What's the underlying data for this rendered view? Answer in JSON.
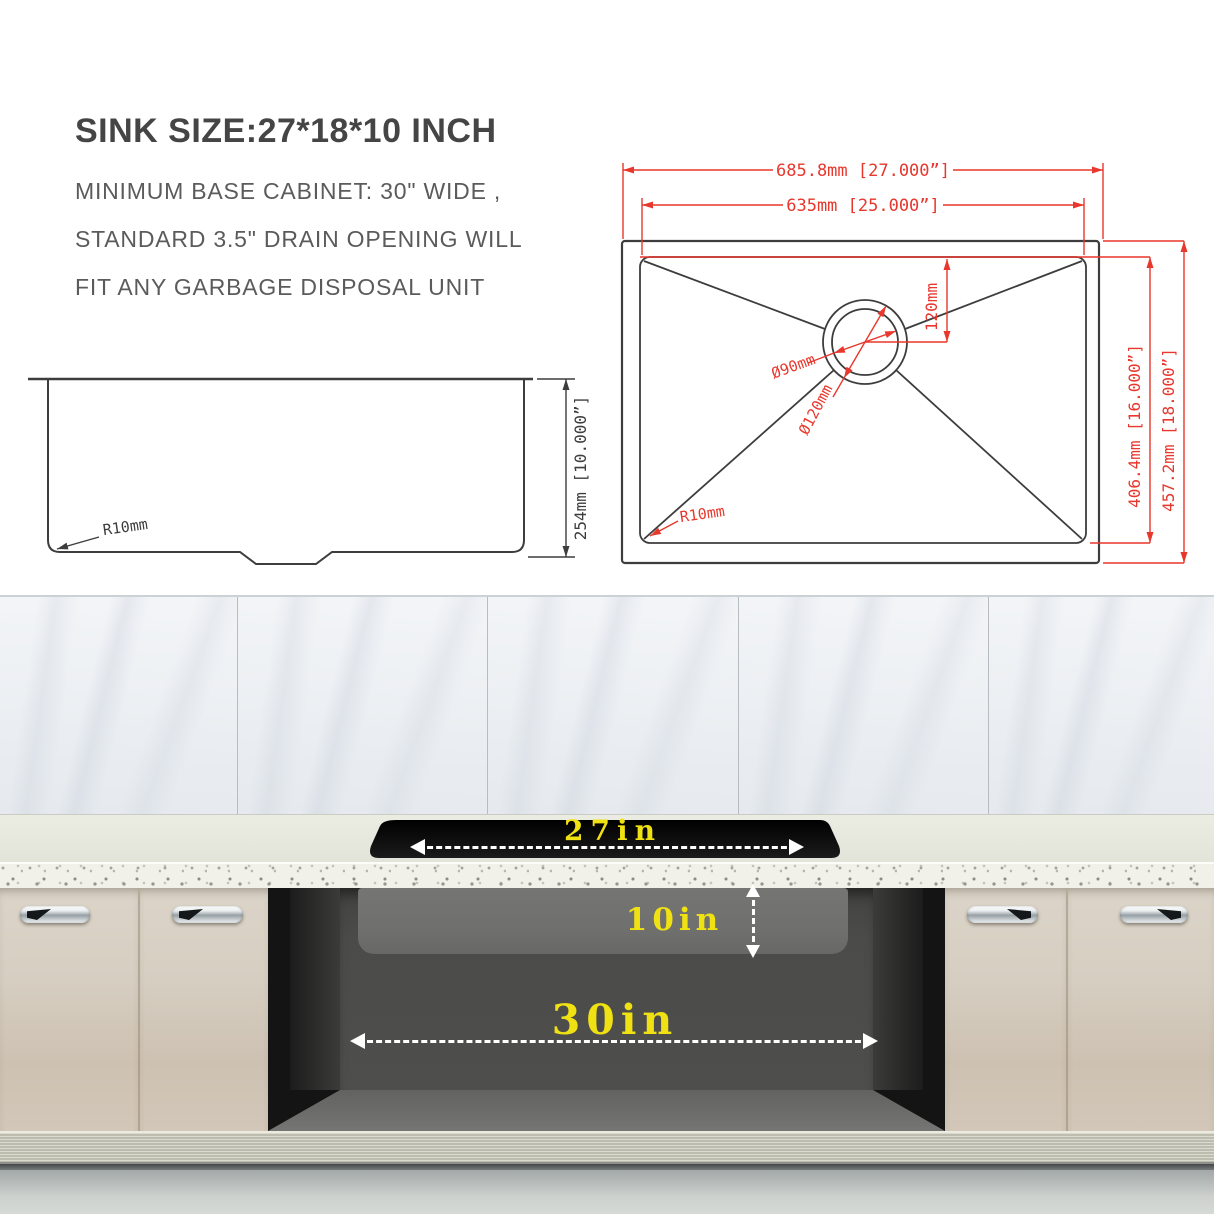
{
  "title_block": {
    "title": "SINK SIZE:27*18*10 INCH",
    "lines": [
      "MINIMUM BASE CABINET: 30\" WIDE ,",
      "STANDARD 3.5\" DRAIN OPENING WILL",
      "FIT ANY GARBAGE DISPOSAL UNIT"
    ]
  },
  "plan_view": {
    "overall_width": "685.8mm [27.000”]",
    "bowl_width": "635mm [25.000”]",
    "drain_offset": "120mm",
    "drain_diameter_inner": "Ø90mm",
    "drain_diameter_outer": "Ø120mm",
    "corner_radius": "R10mm",
    "bowl_depth": "406.4mm [16.000”]",
    "overall_depth": "457.2mm [18.000”]"
  },
  "side_view": {
    "bowl_height": "254mm [10.000”]",
    "corner_radius": "R10mm"
  },
  "installation": {
    "sink_top_width": "27in",
    "sink_bowl_height": "10in",
    "min_cabinet_width": "30in"
  },
  "colors": {
    "dimension_red": "#e8372c",
    "drawing_line": "#3d3d3d",
    "label_yellow": "#f0e112",
    "sink_rim_black": "#0a0a0a",
    "cabinet_door": "#d5cdc0",
    "countertop": "#e9ebe0"
  }
}
